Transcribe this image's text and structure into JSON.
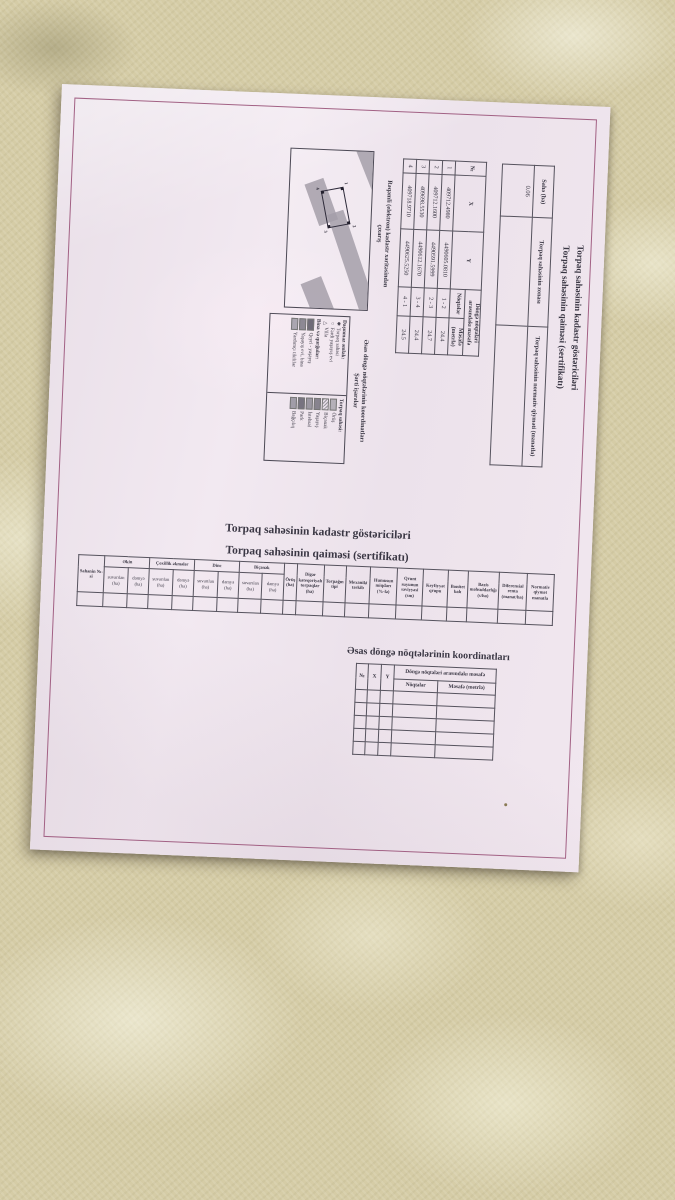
{
  "rotated_section": {
    "title_line1": "Torpaq sahəsinin kadastr göstəriciləri",
    "title_line2": "Torpaq sahəsinin qaiməsi (sertifikatı)",
    "summary_table": {
      "col_area": "Sahə (ha)",
      "col_zone": "Torpaq sahəsinin zonası",
      "col_value": "Torpaq sahəsinin normativ qiyməti (manatla)",
      "area_value": "0.06"
    },
    "coords_table": {
      "col_no": "№",
      "col_x": "X",
      "col_y": "Y",
      "group_header": "Döngə nöqtələri arasındakı məsafə",
      "col_points": "Nöqtələr",
      "col_distance": "Məsafə (metrlə)",
      "rows": [
        {
          "no": "1",
          "x": "409712.4980",
          "y": "4490605.0810",
          "pts": "1 - 2",
          "dist": "24.4"
        },
        {
          "no": "2",
          "x": "409712.1600",
          "y": "4490591.5999",
          "pts": "2 - 3",
          "dist": "24.7"
        },
        {
          "no": "3",
          "x": "409698.5530",
          "y": "4490612.1670",
          "pts": "3 - 4",
          "dist": "24.4"
        },
        {
          "no": "4",
          "x": "409718.9710",
          "y": "4490625.5250",
          "pts": "4 - 1",
          "dist": "24.5"
        }
      ]
    },
    "map": {
      "heading_line1": "Rəqəmli (elektron) kadastr xəritəsindən",
      "heading_line2": "çıxarış",
      "point_labels": [
        "1",
        "2",
        "3",
        "4"
      ]
    },
    "legend": {
      "heading_line1": "Əsas döngə nöqtələrinin koordinatları",
      "heading_line2": "Şərti işarələr",
      "immovable_header": "Daşınmaz əmlak:",
      "symbol_items": [
        {
          "symbol": "✱",
          "label": "Torpaq sahəsi"
        },
        {
          "symbol": "○",
          "label": "Fərdi yaşayış evi"
        },
        {
          "symbol": "△",
          "label": "Villa"
        }
      ],
      "buildings_header": "Bina və qurğular:",
      "building_items": [
        "Qeyri - yaşayış",
        "Yaşayış evi, bina",
        "Yardımçı tikililər"
      ],
      "land_header": "Torpaq sahəsi:",
      "land_items": [
        "Örüş",
        "Biçənək",
        "Yaşayış",
        "İstehsal",
        "Park",
        "Bağçılıq"
      ]
    }
  },
  "lower_section": {
    "title_line1": "Torpaq sahəsinin kadastr göstəriciləri",
    "title_line2": "Torpaq sahəsinin qaiməsi (sertifikatı)",
    "cadastre_table": {
      "col_parcel": "Sahənin №-si",
      "sub_irrigated": "suvarılan (ha)",
      "sub_dry": "dəmyə (ha)",
      "groups": [
        {
          "label": "Əkin"
        },
        {
          "label": "Çoxillik əkmələr"
        },
        {
          "label": "Dinc"
        },
        {
          "label": "Biçənək"
        }
      ],
      "singles": [
        "Örüş (ha)",
        "Digər kateqoriyalı torpaqlar (ha)",
        "Torpağın tipi",
        "Mexaniki tərkib",
        "Humusun miqdarı (%-lə)",
        "Qrunt suyunun səviyyəsi (sm)",
        "Keyfiyyət qrupu",
        "Bonitet balı",
        "Bazis məhsuldarlığı (s/ha)",
        "Diferensial renta (manat/ha)",
        "Normativ qiymət manatla"
      ]
    },
    "coords_heading": "Əsas döngə nöqtələrinin koordinatları",
    "coords_table": {
      "col_no": "№",
      "col_x": "X",
      "col_y": "Y",
      "group_header": "Döngə nöqtələri arasındakı məsafə",
      "col_points": "Nöqtələr",
      "col_distance": "Məsafə (metrlə)",
      "empty_rows": 5
    }
  },
  "colors": {
    "paper": "#f0e7ef",
    "frame_border": "#a26184",
    "ink": "#35323e",
    "fabric": "#d5cca6",
    "map_strip": "#a49fa9"
  }
}
